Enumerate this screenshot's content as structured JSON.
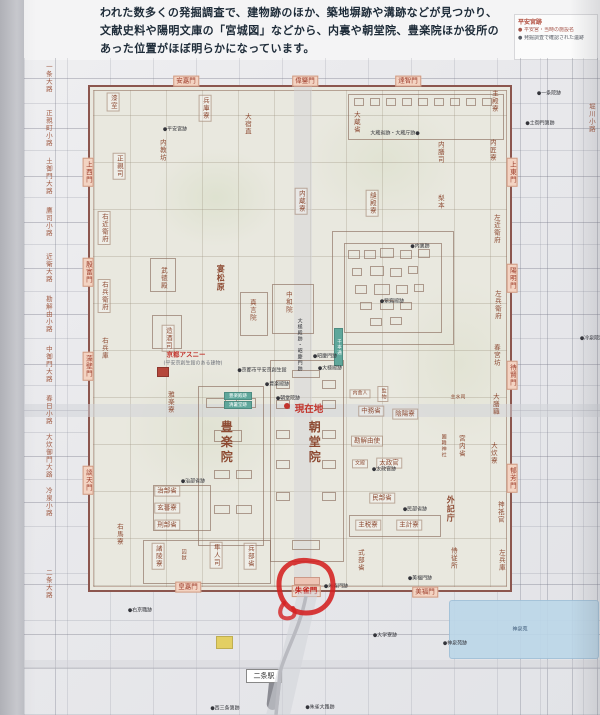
{
  "intro": {
    "lines": [
      "われた数多くの発掘調査で、建物跡のほか、築地塀跡や溝跡などが見つかり、",
      "文献史料や陽明文庫の「宮城図」などから、内裏や朝堂院、豊楽院ほか役所の",
      "あった位置がほぼ明らかになっています。"
    ]
  },
  "legend": {
    "title": "平安宮跡",
    "items": [
      "● 平安宮・当時の施設名",
      "● 発掘調査で確認された遺跡"
    ]
  },
  "highlight": {
    "circled_gate": "朱雀門",
    "marker_color": "#d42020"
  },
  "map": {
    "current_location_label": "現在地",
    "station": {
      "label": "二条駅"
    },
    "pond_label": "神泉苑",
    "left_streets": [
      {
        "label": "一条大路",
        "x": 48,
        "y": 78
      },
      {
        "label": "正親町小路",
        "x": 48,
        "y": 128
      },
      {
        "label": "土御門大路",
        "x": 48,
        "y": 176
      },
      {
        "label": "鷹司小路",
        "x": 48,
        "y": 222
      },
      {
        "label": "近衛大路",
        "x": 48,
        "y": 268
      },
      {
        "label": "勘解由小路",
        "x": 48,
        "y": 314
      },
      {
        "label": "中御門大路",
        "x": 48,
        "y": 364
      },
      {
        "label": "春日小路",
        "x": 48,
        "y": 410
      },
      {
        "label": "大炊御門大路",
        "x": 48,
        "y": 456
      },
      {
        "label": "冷泉小路",
        "x": 48,
        "y": 502
      },
      {
        "label": "二条大路",
        "x": 48,
        "y": 584
      },
      {
        "label": "堀川小路",
        "x": 591,
        "y": 118
      }
    ],
    "gates": [
      {
        "label": "安嘉門",
        "x": 186,
        "y": 81,
        "o": "h"
      },
      {
        "label": "偉鑒門",
        "x": 305,
        "y": 81,
        "o": "h"
      },
      {
        "label": "達智門",
        "x": 408,
        "y": 81,
        "o": "h"
      },
      {
        "label": "上西門",
        "x": 88,
        "y": 172,
        "o": "v"
      },
      {
        "label": "殷富門",
        "x": 88,
        "y": 272,
        "o": "v"
      },
      {
        "label": "藻壁門",
        "x": 88,
        "y": 366,
        "o": "v"
      },
      {
        "label": "談天門",
        "x": 88,
        "y": 480,
        "o": "v"
      },
      {
        "label": "上東門",
        "x": 512,
        "y": 172,
        "o": "v"
      },
      {
        "label": "陽明門",
        "x": 512,
        "y": 278,
        "o": "v"
      },
      {
        "label": "待賢門",
        "x": 512,
        "y": 375,
        "o": "v"
      },
      {
        "label": "郁芳門",
        "x": 512,
        "y": 478,
        "o": "v"
      },
      {
        "label": "皇嘉門",
        "x": 188,
        "y": 587,
        "o": "h"
      },
      {
        "label": "朱雀門",
        "x": 306,
        "y": 591,
        "o": "h",
        "red": true
      },
      {
        "label": "美福門",
        "x": 425,
        "y": 592,
        "o": "h"
      }
    ],
    "buildings": [
      {
        "label": "漆室",
        "x": 113,
        "y": 102,
        "o": "v",
        "s": "sm",
        "b": true
      },
      {
        "label": "兵庫寮",
        "x": 205,
        "y": 108,
        "o": "v",
        "s": "sm",
        "b": true
      },
      {
        "label": "大宿直",
        "x": 247,
        "y": 124,
        "o": "v",
        "s": "sm"
      },
      {
        "label": "正親司",
        "x": 119,
        "y": 166,
        "o": "v",
        "s": "sm",
        "b": true
      },
      {
        "label": "内教坊",
        "x": 162,
        "y": 150,
        "o": "v",
        "s": "sm"
      },
      {
        "label": "大蔵省",
        "x": 356,
        "y": 122,
        "o": "v",
        "s": "sm"
      },
      {
        "label": "内膳司",
        "x": 440,
        "y": 152,
        "o": "v",
        "s": "sm"
      },
      {
        "label": "内匠寮",
        "x": 492,
        "y": 150,
        "o": "v",
        "s": "sm"
      },
      {
        "label": "主殿寮",
        "x": 494,
        "y": 101,
        "o": "v",
        "s": "sm"
      },
      {
        "label": "右近衛府",
        "x": 104,
        "y": 228,
        "o": "v",
        "s": "sm",
        "b": true
      },
      {
        "label": "右兵衛府",
        "x": 104,
        "y": 296,
        "o": "v",
        "s": "sm",
        "b": true
      },
      {
        "label": "右兵庫",
        "x": 104,
        "y": 348,
        "o": "v",
        "s": "sm"
      },
      {
        "label": "武徳殿",
        "x": 163,
        "y": 278,
        "o": "v",
        "s": "sm"
      },
      {
        "label": "宴松原",
        "x": 220,
        "y": 278,
        "o": "v",
        "s": "md"
      },
      {
        "label": "内蔵寮",
        "x": 301,
        "y": 201,
        "o": "v",
        "s": "sm",
        "b": true
      },
      {
        "label": "縫殿寮",
        "x": 372,
        "y": 203,
        "o": "v",
        "s": "sm",
        "b": true
      },
      {
        "label": "梨本",
        "x": 440,
        "y": 202,
        "o": "v",
        "s": "sm"
      },
      {
        "label": "左近衛府",
        "x": 496,
        "y": 229,
        "o": "v",
        "s": "sm"
      },
      {
        "label": "左兵衛府",
        "x": 497,
        "y": 305,
        "o": "v",
        "s": "sm"
      },
      {
        "label": "造酒司",
        "x": 168,
        "y": 338,
        "o": "v",
        "s": "sm",
        "b": true
      },
      {
        "label": "真言院",
        "x": 252,
        "y": 310,
        "o": "v",
        "s": "sm"
      },
      {
        "label": "中和院",
        "x": 288,
        "y": 302,
        "o": "v",
        "s": "sm"
      },
      {
        "label": "春宮坊",
        "x": 496,
        "y": 355,
        "o": "v",
        "s": "sm"
      },
      {
        "label": "大膳職",
        "x": 495,
        "y": 404,
        "o": "v",
        "s": "sm"
      },
      {
        "label": "大炊寮",
        "x": 493,
        "y": 453,
        "o": "v",
        "s": "sm"
      },
      {
        "label": "雅楽寮",
        "x": 170,
        "y": 402,
        "o": "v",
        "s": "sm"
      },
      {
        "label": "豊楽院",
        "x": 226,
        "y": 443,
        "o": "v",
        "s": "xl"
      },
      {
        "label": "朝堂院",
        "x": 314,
        "y": 443,
        "o": "v",
        "s": "xl"
      },
      {
        "label": "内舎人",
        "x": 360,
        "y": 394,
        "o": "h",
        "s": "xs",
        "b": true
      },
      {
        "label": "監物",
        "x": 383,
        "y": 394,
        "o": "v",
        "s": "xs",
        "b": true
      },
      {
        "label": "中務省",
        "x": 371,
        "y": 411,
        "o": "h",
        "s": "sm",
        "b": true
      },
      {
        "label": "陰陽寮",
        "x": 405,
        "y": 414,
        "o": "h",
        "s": "sm",
        "b": true
      },
      {
        "label": "勘解由使",
        "x": 367,
        "y": 441,
        "o": "h",
        "s": "sm",
        "b": true
      },
      {
        "label": "主水司",
        "x": 458,
        "y": 398,
        "o": "h",
        "s": "xs"
      },
      {
        "label": "園韓神社",
        "x": 443,
        "y": 446,
        "o": "v",
        "s": "xs"
      },
      {
        "label": "宮内省",
        "x": 461,
        "y": 446,
        "o": "v",
        "s": "sm"
      },
      {
        "label": "文殿",
        "x": 360,
        "y": 464,
        "o": "h",
        "s": "xs",
        "b": true
      },
      {
        "label": "太政官",
        "x": 389,
        "y": 463,
        "o": "h",
        "s": "sm",
        "b": true
      },
      {
        "label": "民部省",
        "x": 382,
        "y": 498,
        "o": "h",
        "s": "sm",
        "b": true
      },
      {
        "label": "主税寮",
        "x": 368,
        "y": 525,
        "o": "h",
        "s": "sm",
        "b": true
      },
      {
        "label": "主計寮",
        "x": 409,
        "y": 525,
        "o": "h",
        "s": "sm",
        "b": true
      },
      {
        "label": "式部省",
        "x": 360,
        "y": 560,
        "o": "v",
        "s": "sm"
      },
      {
        "label": "外記庁",
        "x": 450,
        "y": 509,
        "o": "v",
        "s": "md"
      },
      {
        "label": "侍従所",
        "x": 453,
        "y": 558,
        "o": "v",
        "s": "sm"
      },
      {
        "label": "神祇官",
        "x": 500,
        "y": 512,
        "o": "v",
        "s": "sm"
      },
      {
        "label": "左兵庫",
        "x": 501,
        "y": 560,
        "o": "v",
        "s": "sm"
      },
      {
        "label": "治部省",
        "x": 167,
        "y": 491,
        "o": "h",
        "s": "sm",
        "b": true
      },
      {
        "label": "玄蕃寮",
        "x": 167,
        "y": 508,
        "o": "h",
        "s": "sm",
        "b": true
      },
      {
        "label": "刑部省",
        "x": 167,
        "y": 525,
        "o": "h",
        "s": "sm",
        "b": true
      },
      {
        "label": "右馬寮",
        "x": 119,
        "y": 534,
        "o": "v",
        "s": "sm"
      },
      {
        "label": "諸陵寮",
        "x": 158,
        "y": 556,
        "o": "v",
        "s": "sm",
        "b": true
      },
      {
        "label": "囚獄",
        "x": 183,
        "y": 555,
        "o": "v",
        "s": "xs"
      },
      {
        "label": "隼人司",
        "x": 216,
        "y": 555,
        "o": "v",
        "s": "sm",
        "b": true
      },
      {
        "label": "兵部省",
        "x": 250,
        "y": 556,
        "o": "v",
        "s": "sm",
        "b": true
      },
      {
        "label": "京都アスニー",
        "x": 186,
        "y": 355,
        "o": "h",
        "s": "sm",
        "c": "red"
      },
      {
        "label": "(平安京創生館のある建物)",
        "x": 193,
        "y": 364,
        "o": "h",
        "s": "xs",
        "c": "gray"
      }
    ],
    "current_location": {
      "x": 309,
      "y": 410
    },
    "annotations": [
      {
        "label": "大蔵省跡・大蔵庁跡●",
        "x": 395,
        "y": 134
      },
      {
        "label": "●平安宮跡",
        "x": 175,
        "y": 130
      },
      {
        "label": "●京都市平安京創生館",
        "x": 262,
        "y": 371
      },
      {
        "label": "●豊楽殿跡",
        "x": 277,
        "y": 385
      },
      {
        "label": "●昭慶門跡",
        "x": 325,
        "y": 357
      },
      {
        "label": "●大極殿跡",
        "x": 330,
        "y": 369
      },
      {
        "label": "●朝堂院跡",
        "x": 288,
        "y": 399
      },
      {
        "label": "大極殿跡・昭慶門跡",
        "x": 299,
        "y": 345,
        "o": "v"
      },
      {
        "label": "●内裏跡",
        "x": 420,
        "y": 247
      },
      {
        "label": "●紫宸殿跡",
        "x": 392,
        "y": 302
      },
      {
        "label": "●治部省跡",
        "x": 193,
        "y": 482
      },
      {
        "label": "●太政官跡",
        "x": 384,
        "y": 470
      },
      {
        "label": "●民部省跡",
        "x": 415,
        "y": 510
      },
      {
        "label": "●朱雀門跡",
        "x": 336,
        "y": 587
      },
      {
        "label": "●美福門跡",
        "x": 420,
        "y": 579
      },
      {
        "label": "●一条院跡",
        "x": 549,
        "y": 94
      },
      {
        "label": "●土御門第跡",
        "x": 540,
        "y": 124
      },
      {
        "label": "●冷泉院跡",
        "x": 592,
        "y": 339
      },
      {
        "label": "●大学寮跡",
        "x": 385,
        "y": 636
      },
      {
        "label": "●神泉苑跡",
        "x": 455,
        "y": 644
      },
      {
        "label": "●右京職跡",
        "x": 140,
        "y": 611
      },
      {
        "label": "●西三条第跡",
        "x": 225,
        "y": 709
      },
      {
        "label": "●朱雀大路跡",
        "x": 320,
        "y": 708
      }
    ],
    "compounds": [
      {
        "x": 332,
        "y": 231,
        "w": 122,
        "h": 114
      },
      {
        "x": 344,
        "y": 243,
        "w": 98,
        "h": 90
      },
      {
        "x": 270,
        "y": 360,
        "w": 74,
        "h": 202
      },
      {
        "x": 198,
        "y": 386,
        "w": 66,
        "h": 160
      },
      {
        "x": 272,
        "y": 284,
        "w": 42,
        "h": 50
      },
      {
        "x": 240,
        "y": 292,
        "w": 28,
        "h": 44
      },
      {
        "x": 348,
        "y": 94,
        "w": 156,
        "h": 46
      },
      {
        "x": 153,
        "y": 485,
        "w": 58,
        "h": 46
      },
      {
        "x": 143,
        "y": 540,
        "w": 128,
        "h": 44
      },
      {
        "x": 349,
        "y": 515,
        "w": 92,
        "h": 22
      },
      {
        "x": 150,
        "y": 258,
        "w": 26,
        "h": 34
      },
      {
        "x": 152,
        "y": 315,
        "w": 30,
        "h": 34
      }
    ],
    "boxes": [
      {
        "x": 348,
        "y": 250,
        "w": 12,
        "h": 9
      },
      {
        "x": 364,
        "y": 250,
        "w": 12,
        "h": 9
      },
      {
        "x": 380,
        "y": 248,
        "w": 14,
        "h": 10
      },
      {
        "x": 400,
        "y": 250,
        "w": 12,
        "h": 9
      },
      {
        "x": 418,
        "y": 249,
        "w": 12,
        "h": 9
      },
      {
        "x": 352,
        "y": 268,
        "w": 10,
        "h": 8
      },
      {
        "x": 370,
        "y": 266,
        "w": 14,
        "h": 10
      },
      {
        "x": 390,
        "y": 268,
        "w": 12,
        "h": 9
      },
      {
        "x": 408,
        "y": 266,
        "w": 10,
        "h": 8
      },
      {
        "x": 355,
        "y": 285,
        "w": 12,
        "h": 9
      },
      {
        "x": 374,
        "y": 284,
        "w": 16,
        "h": 11
      },
      {
        "x": 396,
        "y": 285,
        "w": 12,
        "h": 9
      },
      {
        "x": 414,
        "y": 284,
        "w": 10,
        "h": 8
      },
      {
        "x": 360,
        "y": 302,
        "w": 12,
        "h": 8
      },
      {
        "x": 380,
        "y": 300,
        "w": 14,
        "h": 10
      },
      {
        "x": 400,
        "y": 302,
        "w": 12,
        "h": 8
      },
      {
        "x": 370,
        "y": 318,
        "w": 12,
        "h": 8
      },
      {
        "x": 390,
        "y": 317,
        "w": 12,
        "h": 8
      },
      {
        "x": 276,
        "y": 380,
        "w": 14,
        "h": 9
      },
      {
        "x": 322,
        "y": 380,
        "w": 14,
        "h": 9
      },
      {
        "x": 276,
        "y": 400,
        "w": 14,
        "h": 9
      },
      {
        "x": 322,
        "y": 400,
        "w": 14,
        "h": 9
      },
      {
        "x": 276,
        "y": 430,
        "w": 14,
        "h": 9
      },
      {
        "x": 322,
        "y": 430,
        "w": 14,
        "h": 9
      },
      {
        "x": 276,
        "y": 460,
        "w": 14,
        "h": 9
      },
      {
        "x": 322,
        "y": 460,
        "w": 14,
        "h": 9
      },
      {
        "x": 276,
        "y": 492,
        "w": 14,
        "h": 9
      },
      {
        "x": 322,
        "y": 492,
        "w": 14,
        "h": 9
      },
      {
        "x": 292,
        "y": 540,
        "w": 28,
        "h": 10
      },
      {
        "x": 292,
        "y": 370,
        "w": 28,
        "h": 8
      },
      {
        "x": 206,
        "y": 398,
        "w": 20,
        "h": 10
      },
      {
        "x": 236,
        "y": 398,
        "w": 20,
        "h": 10
      },
      {
        "x": 214,
        "y": 430,
        "w": 28,
        "h": 12
      },
      {
        "x": 214,
        "y": 470,
        "w": 16,
        "h": 9
      },
      {
        "x": 236,
        "y": 470,
        "w": 16,
        "h": 9
      },
      {
        "x": 214,
        "y": 505,
        "w": 16,
        "h": 9
      },
      {
        "x": 236,
        "y": 505,
        "w": 16,
        "h": 9
      },
      {
        "x": 354,
        "y": 98,
        "w": 10,
        "h": 8
      },
      {
        "x": 370,
        "y": 98,
        "w": 10,
        "h": 8
      },
      {
        "x": 386,
        "y": 98,
        "w": 10,
        "h": 8
      },
      {
        "x": 402,
        "y": 98,
        "w": 10,
        "h": 8
      },
      {
        "x": 418,
        "y": 98,
        "w": 10,
        "h": 8
      },
      {
        "x": 434,
        "y": 98,
        "w": 10,
        "h": 8
      },
      {
        "x": 450,
        "y": 98,
        "w": 10,
        "h": 8
      },
      {
        "x": 466,
        "y": 98,
        "w": 10,
        "h": 8
      },
      {
        "x": 482,
        "y": 98,
        "w": 10,
        "h": 8
      }
    ],
    "special_boxes": [
      {
        "x": 294,
        "y": 577,
        "w": 26,
        "h": 8,
        "fill": "pink",
        "name": "suzakumon-gate-platform"
      },
      {
        "x": 157,
        "y": 367,
        "w": 12,
        "h": 10,
        "fill": "red",
        "name": "kyoto-asny-building"
      },
      {
        "x": 216,
        "y": 636,
        "w": 17,
        "h": 13,
        "fill": "yellow",
        "name": "modern-building"
      }
    ],
    "teal_tags": [
      {
        "label": "豊楽殿跡",
        "x": 224,
        "y": 392,
        "w": 28,
        "h": 8,
        "o": "h"
      },
      {
        "label": "清暑堂跡",
        "x": 224,
        "y": 401,
        "w": 28,
        "h": 8,
        "o": "h"
      },
      {
        "label": "千本通",
        "x": 334,
        "y": 328,
        "w": 9,
        "h": 38,
        "o": "v"
      }
    ],
    "h_streets_y": [
      78,
      128,
      176,
      222,
      268,
      314,
      364,
      410,
      456,
      502,
      584,
      634,
      668
    ],
    "v_streets_x": [
      55,
      520,
      547,
      572,
      597
    ]
  }
}
